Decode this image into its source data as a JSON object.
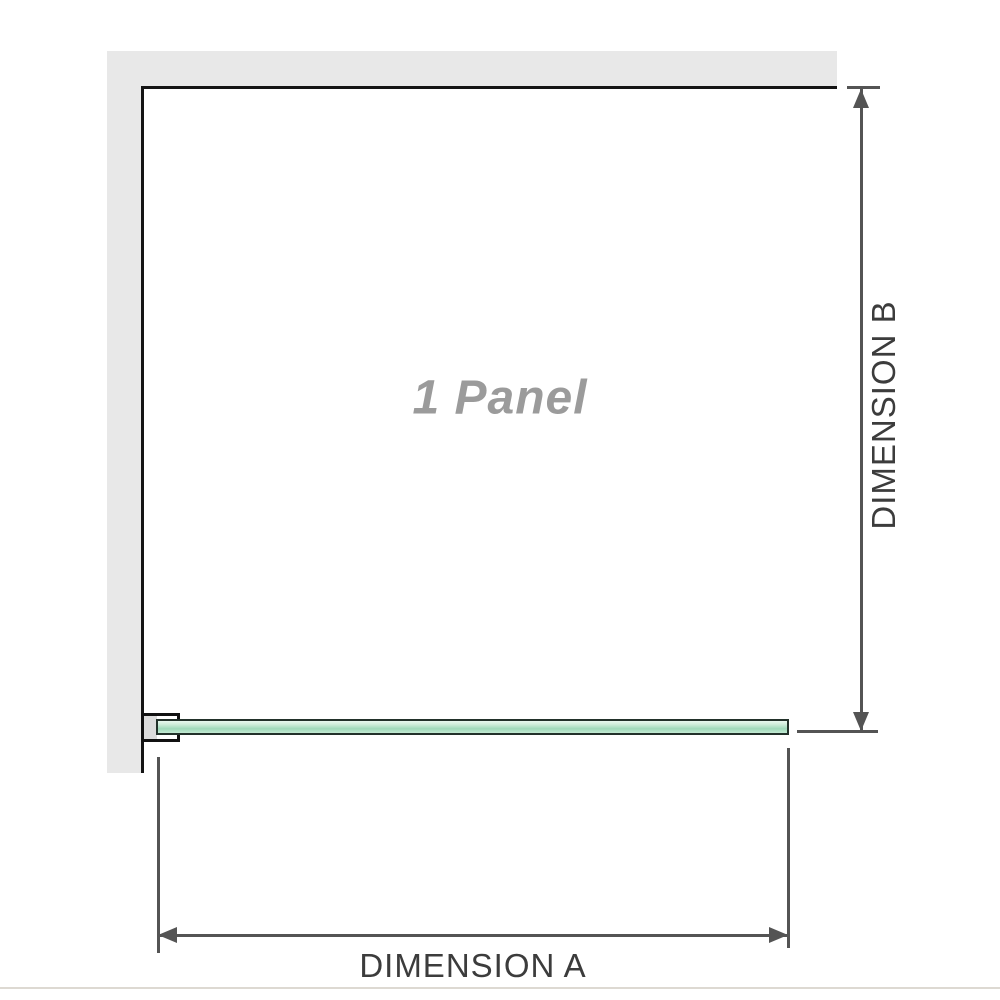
{
  "diagram": {
    "panel_label": "1 Panel",
    "dimension_a_label": "DIMENSION A",
    "dimension_b_label": "DIMENSION B",
    "colors": {
      "background": "#ffffff",
      "wall_fill": "#e8e8e8",
      "wall_edge_line": "#141414",
      "glass_fill_light": "#e9f8f0",
      "glass_fill_mid": "#9fd9ba",
      "glass_border": "#22312a",
      "bracket_border": "#111111",
      "bracket_pad_fill": "#dcdcdc",
      "dimension_line": "#545454",
      "dimension_label_text": "#3c3c3c",
      "panel_label_text": "#9b9b9b",
      "footer_hairline": "#ddd9d2"
    }
  }
}
